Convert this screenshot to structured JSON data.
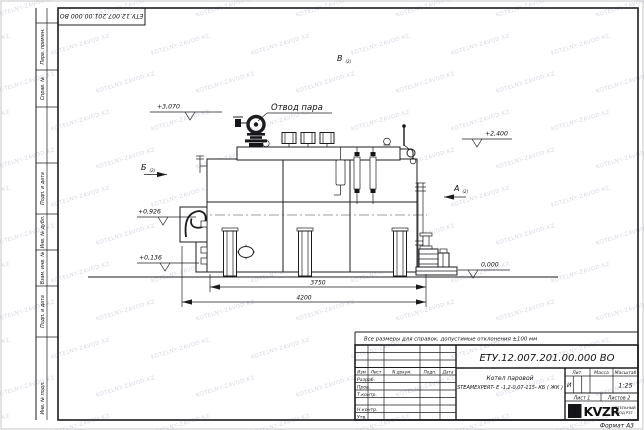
{
  "watermark": {
    "text": "KOTELNY-ZAVOD.KZ"
  },
  "stamp_top": {
    "doc_number": "ЕТУ.12.007.201.00.000  ВО"
  },
  "frame": {
    "margin_labels": [
      "Перв. примен.",
      "Справ. №",
      "Подп. и дата",
      "Инв. № дубл.",
      "Взам. инв. №",
      "Подп. и дата",
      "Инв. № подл."
    ]
  },
  "drawing": {
    "callout_steam_outlet": "Отвод пара",
    "views": {
      "a": "А",
      "b": "Б",
      "v": "В",
      "sheet_ref": "(2)"
    },
    "elevations": {
      "e3070": "+3,070",
      "e2400": "+2,400",
      "e0926": "+0,926",
      "e0136": "+0,136",
      "e0000": "0,000"
    },
    "dimensions": {
      "d3750": "3750",
      "d4200": "4200"
    }
  },
  "note": "Все размеры для справок, допустимые отклонения  ±100 мм",
  "title_block": {
    "doc_number": "ЕТУ.12.007.201.00.000  ВО",
    "product_name_line1": "Котел паровой",
    "product_name_line2": "STEAMEXPERT- Е -1,2-0,07-115- КБ ( ЖК )",
    "headers": {
      "lit": "Лит.",
      "mass": "Масса",
      "scale": "Масштаб"
    },
    "lit_value": "И",
    "scale_value": "1:25",
    "sheet": "Лист 1",
    "sheets": "Листов 2",
    "columns": {
      "izm": "Изм",
      "list": "Лист",
      "doc": "N докум.",
      "podp": "Подп.",
      "data": "Дата"
    },
    "rows": {
      "razrab": "Разраб.",
      "prov": "Пров.",
      "tkontr": "Т.контр.",
      "nkontr": "Н.контр.",
      "utv": "Утв."
    },
    "logo_text": "KVZR",
    "company_line1": "КОТЕЛЬНЫЙ",
    "company_line2": "ЗАВОД РЗТ",
    "format": "Формат А3"
  }
}
